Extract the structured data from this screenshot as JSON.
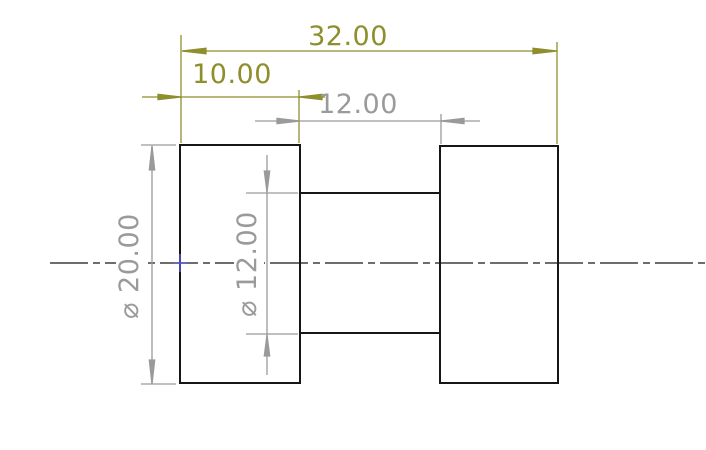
{
  "drawing": {
    "dimensions": {
      "overall_length": {
        "label": "32.00"
      },
      "left_flange_width": {
        "label": "10.00"
      },
      "shaft_length": {
        "label": "12.00"
      },
      "flange_diameter": {
        "label": "⌀ 20.00"
      },
      "shaft_diameter": {
        "label": "⌀ 12.00"
      }
    },
    "colors": {
      "dimension_olive": "#8e8e2d",
      "dimension_gray": "#9a9a9a",
      "part_edge": "#161616",
      "centerline": "#161616",
      "center_mark_blue": "#5353c0",
      "background": "#ffffff"
    }
  }
}
